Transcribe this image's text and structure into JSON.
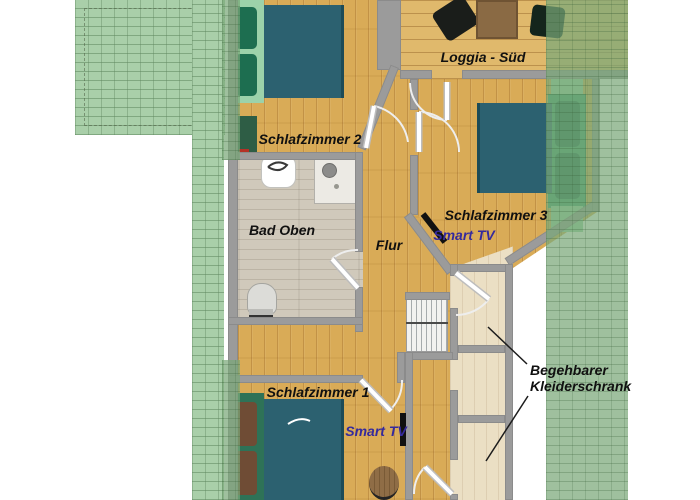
{
  "labels": {
    "bedroom2": "Schlafzimmer 2",
    "loggia_sued": "Loggia - Süd",
    "bedroom3": "Schlafzimmer 3",
    "bedroom3_tv": "Smart TV",
    "bathroom": "Bad Oben",
    "hallway": "Flur",
    "bedroom1": "Schlafzimmer 1",
    "bedroom1_tv": "Smart TV",
    "walkin_closet_line1": "Begehbarer",
    "walkin_closet_line2": "Kleiderschrank"
  },
  "colors": {
    "roof_green": "#a9cfa9",
    "wall_grey": "#9b9b9b",
    "bedroom_wood_floor": "#d9ab57",
    "loggia_wood_floor": "#e0b96c",
    "bathroom_floor": "#d0c9bb",
    "closet_floor": "#ebdfc4",
    "mattress_teal": "#2c6170",
    "pillow_green": "#1d6e50",
    "pillow_brown": "#6f4c35",
    "smart_tv_text": "#352a9d",
    "tv_black": "#111111",
    "label_text": "#101010"
  }
}
